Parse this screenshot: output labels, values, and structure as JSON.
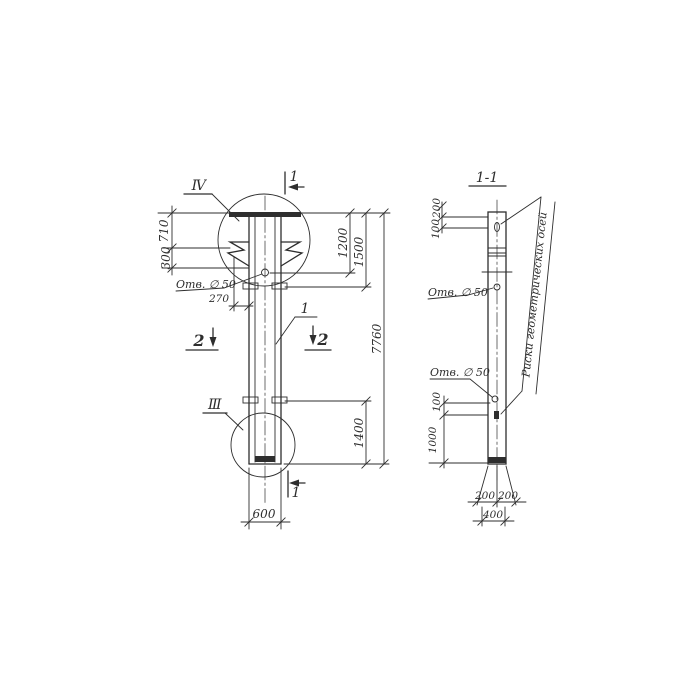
{
  "colors": {
    "paper": "#ffffff",
    "ink": "#2e2e2e"
  },
  "left_view": {
    "detail_top_label": "IV",
    "detail_bottom_label": "III",
    "section_top_label": "1",
    "section_bottom_label": "1",
    "section_left_label": "2",
    "section_right_label": "2",
    "part_callout": "1",
    "hole_label": "Отв. ∅ 50",
    "dims": {
      "d710": "710",
      "d300": "300",
      "d270": "270",
      "d1200": "1200",
      "d1500": "1500",
      "d7760": "7760",
      "d1400": "1400",
      "d600": "600"
    }
  },
  "right_view": {
    "section_title": "1-1",
    "hole_label_upper": "Отв. ∅ 50",
    "hole_label_lower": "Отв. ∅ 50",
    "axis_note": "Риски геометрических осей",
    "dims": {
      "d200_top": "200",
      "d100_top": "100",
      "d100_mid": "100",
      "d1000": "1000",
      "d200_bl": "200",
      "d200_br": "200",
      "d400": "400"
    }
  }
}
